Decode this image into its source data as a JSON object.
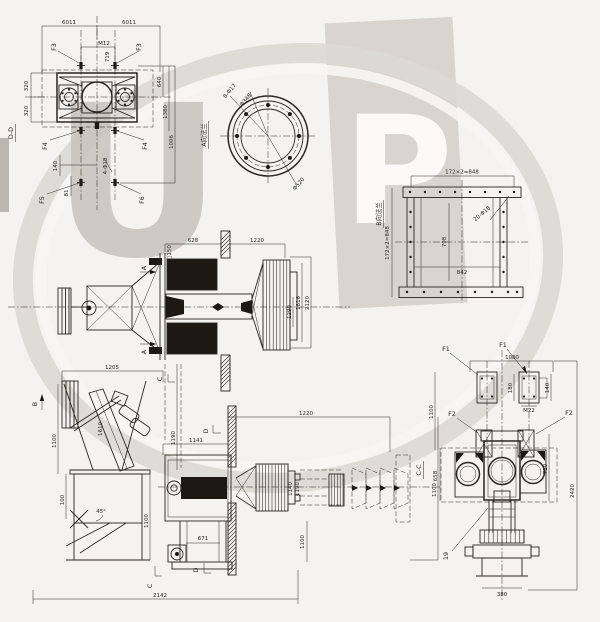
{
  "drawing": {
    "watermark": {
      "letter_u": "U",
      "letter_p": "P",
      "patch_color": "#d8d5d0",
      "ring_color": "#dcd9d4",
      "letter_u_color": "#c7c4be",
      "letter_p_color": "#fbfaf7"
    },
    "views": {
      "dd": {
        "title": "D-D",
        "dims": {
          "top_left": "6011",
          "top_right": "6011",
          "bolt": "M12",
          "pitch": "719",
          "left_top": "320",
          "left_bot": "320",
          "right_1": "640",
          "right_2": "1380",
          "right_3": "1006",
          "low_left": "140",
          "low_small": "81",
          "holes": "4-Φ18"
        },
        "flags": {
          "f3l": "F3",
          "f3r": "F3",
          "f4l": "F4",
          "f4r": "F4",
          "f5": "F5",
          "f6": "F6"
        }
      },
      "fa": {
        "title": "A向法兰",
        "dims": {
          "holes": "8-Φ17",
          "bolt_circle": "Φ348",
          "outer": "Φ520"
        }
      },
      "fb": {
        "title": "B向法兰",
        "dims": {
          "top": "172×2=848",
          "left": "172×2=848",
          "height": "798",
          "width": "842",
          "holes": "20-Φ18"
        }
      },
      "fe": {
        "arrow": "A",
        "dims": {
          "len_left": "628",
          "len_right": "1220",
          "inlet": "□150",
          "r1": "1290",
          "r2": "1816",
          "r3": "2120"
        }
      },
      "se": {
        "arrow": "B",
        "marks": {
          "c_top": "C",
          "c_bot": "C",
          "d_bot": "D"
        },
        "dims": {
          "top": "1205",
          "chute": "1610",
          "left_h": "1100",
          "left_s": "100",
          "angle": "45°",
          "right_1": "1190",
          "right_2": "1100",
          "bottom": "2142"
        }
      },
      "pm": {
        "mark": "D",
        "dims": {
          "top": "1220",
          "left": "1141",
          "mid": "671",
          "d1": "1140",
          "d2": "1190",
          "right": "1100",
          "col": "1100"
        }
      },
      "cc": {
        "title": "C-C",
        "flags": {
          "f1l": "F1",
          "f1r": "F1",
          "f2l": "F2",
          "f2r": "F2",
          "part": "19"
        },
        "dims": {
          "top": "1080",
          "f_side": "180",
          "f_side2": "140",
          "thread": "M22",
          "left_1": "1100",
          "left_2": "658",
          "right_1": "710",
          "right_2": "2420",
          "base": "380"
        }
      }
    }
  }
}
